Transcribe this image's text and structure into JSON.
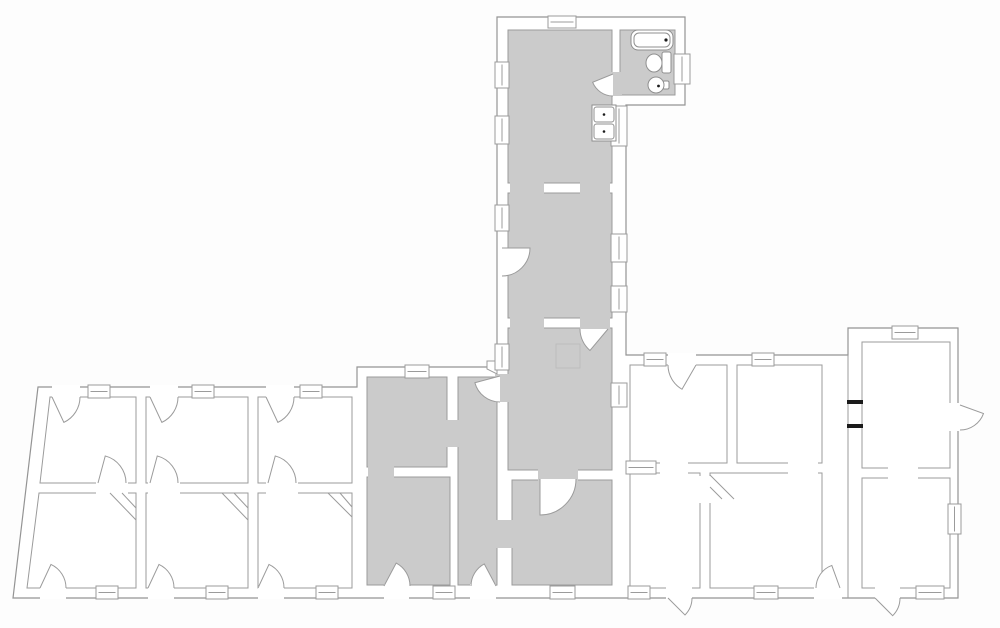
{
  "floor_plan": {
    "canvas": {
      "width": 1000,
      "height": 628,
      "background": "#fdfdfd"
    },
    "colors": {
      "wall_line": "#9b9b9b",
      "outline_line": "#949494",
      "room_fill": "#ffffff",
      "shaded_fill": "#cbcbcb",
      "fixture_line": "#8f8f8f",
      "black_accent": "#1b1b1b",
      "hatch_line": "#bdbdbd"
    },
    "outline": [
      [
        497,
        17
      ],
      [
        685,
        17
      ],
      [
        685,
        105
      ],
      [
        626,
        105
      ],
      [
        626,
        355
      ],
      [
        848,
        355
      ],
      [
        848,
        328
      ],
      [
        958,
        328
      ],
      [
        958,
        598
      ],
      [
        13,
        598
      ],
      [
        38,
        387
      ],
      [
        357,
        387
      ],
      [
        357,
        367
      ],
      [
        497,
        367
      ]
    ],
    "rooms": [
      {
        "id": "kitchen",
        "shaded": true,
        "rect": [
          508,
          30,
          104,
          153
        ]
      },
      {
        "id": "bathroom",
        "shaded": true,
        "rect": [
          620,
          30,
          55,
          65
        ]
      },
      {
        "id": "middle-room",
        "shaded": true,
        "rect": [
          508,
          193,
          104,
          125
        ]
      },
      {
        "id": "lower-room",
        "shaded": true,
        "rect": [
          508,
          328,
          104,
          142
        ]
      },
      {
        "id": "m1",
        "shaded": true,
        "rect": [
          367,
          377,
          80,
          90
        ]
      },
      {
        "id": "m2",
        "shaded": true,
        "rect": [
          367,
          477,
          83,
          108
        ]
      },
      {
        "id": "hallway",
        "shaded": true,
        "rect": [
          458,
          377,
          39,
          208
        ]
      },
      {
        "id": "m3",
        "shaded": true,
        "rect": [
          512,
          480,
          100,
          105
        ]
      },
      {
        "id": "a1",
        "shaded": false,
        "poly": [
          [
            50,
            397
          ],
          [
            136,
            397
          ],
          [
            136,
            483
          ],
          [
            40,
            483
          ]
        ]
      },
      {
        "id": "a2",
        "shaded": false,
        "rect": [
          146,
          397,
          102,
          86
        ]
      },
      {
        "id": "a3",
        "shaded": false,
        "rect": [
          258,
          397,
          94,
          86
        ]
      },
      {
        "id": "b1",
        "shaded": false,
        "poly": [
          [
            39,
            493
          ],
          [
            136,
            493
          ],
          [
            136,
            588
          ],
          [
            27,
            588
          ]
        ]
      },
      {
        "id": "b2",
        "shaded": false,
        "rect": [
          146,
          493,
          102,
          95
        ]
      },
      {
        "id": "b3",
        "shaded": false,
        "rect": [
          258,
          493,
          94,
          95
        ]
      },
      {
        "id": "r1",
        "shaded": false,
        "rect": [
          630,
          365,
          97,
          98
        ]
      },
      {
        "id": "r2",
        "shaded": false,
        "rect": [
          737,
          365,
          85,
          98
        ]
      },
      {
        "id": "r3",
        "shaded": false,
        "rect": [
          630,
          473,
          70,
          115
        ]
      },
      {
        "id": "r4",
        "shaded": false,
        "rect": [
          710,
          473,
          112,
          115
        ]
      },
      {
        "id": "f1",
        "shaded": false,
        "rect": [
          862,
          342,
          88,
          126
        ]
      },
      {
        "id": "f2",
        "shaded": false,
        "rect": [
          862,
          478,
          88,
          110
        ]
      }
    ],
    "wall_openings": [
      {
        "fill": "shaded",
        "rect": [
          510,
          181,
          34,
          14
        ]
      },
      {
        "fill": "shaded",
        "rect": [
          580,
          181,
          30,
          14
        ]
      },
      {
        "fill": "shaded",
        "rect": [
          510,
          316,
          34,
          14
        ]
      },
      {
        "fill": "shaded",
        "rect": [
          580,
          316,
          30,
          14
        ]
      },
      {
        "fill": "shaded",
        "rect": [
          610,
          72,
          12,
          24
        ]
      },
      {
        "fill": "shaded",
        "rect": [
          368,
          465,
          26,
          14
        ]
      },
      {
        "fill": "shaded",
        "rect": [
          445,
          420,
          15,
          27
        ]
      },
      {
        "fill": "shaded",
        "rect": [
          495,
          374,
          17,
          28
        ]
      },
      {
        "fill": "shaded",
        "rect": [
          495,
          520,
          19,
          28
        ]
      },
      {
        "fill": "shaded",
        "rect": [
          538,
          466,
          40,
          16
        ]
      },
      {
        "fill": "room",
        "rect": [
          96,
          481,
          32,
          14
        ]
      },
      {
        "fill": "room",
        "rect": [
          148,
          481,
          32,
          14
        ]
      },
      {
        "fill": "room",
        "rect": [
          266,
          481,
          32,
          14
        ]
      },
      {
        "fill": "room",
        "rect": [
          660,
          461,
          28,
          14
        ]
      },
      {
        "fill": "room",
        "rect": [
          788,
          461,
          30,
          14
        ]
      },
      {
        "fill": "room",
        "rect": [
          698,
          476,
          14,
          27
        ]
      },
      {
        "fill": "room",
        "rect": [
          888,
          466,
          30,
          14
        ]
      },
      {
        "fill": "room",
        "rect": [
          52,
          385,
          28,
          13
        ]
      },
      {
        "fill": "room",
        "rect": [
          150,
          385,
          28,
          13
        ]
      },
      {
        "fill": "room",
        "rect": [
          266,
          385,
          28,
          13
        ]
      },
      {
        "fill": "room",
        "rect": [
          40,
          586,
          26,
          13
        ]
      },
      {
        "fill": "room",
        "rect": [
          148,
          586,
          26,
          13
        ]
      },
      {
        "fill": "room",
        "rect": [
          258,
          586,
          26,
          13
        ]
      },
      {
        "fill": "room",
        "rect": [
          384,
          584,
          25,
          15
        ]
      },
      {
        "fill": "room",
        "rect": [
          470,
          584,
          26,
          15
        ]
      },
      {
        "fill": "room",
        "rect": [
          668,
          353,
          28,
          13
        ]
      },
      {
        "fill": "room",
        "rect": [
          666,
          586,
          26,
          13
        ]
      },
      {
        "fill": "room",
        "rect": [
          814,
          586,
          28,
          13
        ]
      },
      {
        "fill": "room",
        "rect": [
          875,
          586,
          25,
          13
        ]
      },
      {
        "fill": "room",
        "rect": [
          948,
          403,
          13,
          28
        ]
      }
    ],
    "extra_wall_lines": [
      [
        848,
        355,
        848,
        598
      ]
    ],
    "windows": [
      [
        548,
        16,
        28,
        12
      ],
      [
        495,
        62,
        14,
        26
      ],
      [
        495,
        116,
        14,
        28
      ],
      [
        611,
        106,
        16,
        40
      ],
      [
        674,
        54,
        16,
        30
      ],
      [
        495,
        205,
        14,
        26
      ],
      [
        611,
        234,
        16,
        28
      ],
      [
        611,
        286,
        16,
        26
      ],
      [
        495,
        344,
        14,
        26
      ],
      [
        611,
        383,
        16,
        24
      ],
      [
        88,
        385,
        22,
        13
      ],
      [
        192,
        385,
        22,
        13
      ],
      [
        300,
        385,
        22,
        13
      ],
      [
        96,
        586,
        22,
        13
      ],
      [
        206,
        586,
        22,
        13
      ],
      [
        316,
        586,
        22,
        13
      ],
      [
        405,
        365,
        24,
        13
      ],
      [
        433,
        586,
        22,
        13
      ],
      [
        550,
        586,
        25,
        13
      ],
      [
        644,
        353,
        22,
        13
      ],
      [
        752,
        353,
        22,
        13
      ],
      [
        626,
        461,
        30,
        13
      ],
      [
        628,
        586,
        22,
        13
      ],
      [
        754,
        586,
        24,
        13
      ],
      [
        892,
        326,
        26,
        13
      ],
      [
        948,
        504,
        13,
        30
      ],
      [
        916,
        586,
        28,
        13
      ]
    ],
    "doors": [
      {
        "id": "entry-a1",
        "hinge": [
          52,
          397
        ],
        "strike": [
          80,
          397
        ],
        "open_deg": 65
      },
      {
        "id": "entry-a2",
        "hinge": [
          150,
          397
        ],
        "strike": [
          178,
          397
        ],
        "open_deg": 65
      },
      {
        "id": "entry-a3",
        "hinge": [
          266,
          397
        ],
        "strike": [
          294,
          397
        ],
        "open_deg": 65
      },
      {
        "id": "mid-a1",
        "hinge": [
          98,
          483
        ],
        "strike": [
          126,
          483
        ],
        "open_deg": -75
      },
      {
        "id": "mid-a2",
        "hinge": [
          150,
          483
        ],
        "strike": [
          178,
          483
        ],
        "open_deg": -75
      },
      {
        "id": "mid-a3",
        "hinge": [
          268,
          483
        ],
        "strike": [
          296,
          483
        ],
        "open_deg": -75
      },
      {
        "id": "entry-b1",
        "hinge": [
          40,
          588
        ],
        "strike": [
          66,
          588
        ],
        "open_deg": -65
      },
      {
        "id": "entry-b2",
        "hinge": [
          148,
          588
        ],
        "strike": [
          174,
          588
        ],
        "open_deg": -65
      },
      {
        "id": "entry-b3",
        "hinge": [
          258,
          588
        ],
        "strike": [
          284,
          588
        ],
        "open_deg": -65
      },
      {
        "id": "entry-m2",
        "hinge": [
          384,
          586
        ],
        "strike": [
          410,
          586
        ],
        "open_deg": -62
      },
      {
        "id": "entry-hall",
        "hinge": [
          496,
          586
        ],
        "strike": [
          471,
          586
        ],
        "open_deg": 62
      },
      {
        "id": "kitchen-bath",
        "hinge": [
          613,
          74
        ],
        "strike": [
          613,
          96
        ],
        "open_deg": 68
      },
      {
        "id": "middle-room-west",
        "hinge": [
          502,
          248
        ],
        "strike": [
          502,
          276
        ],
        "open_deg": -90
      },
      {
        "id": "middle-lower",
        "hinge": [
          608,
          329
        ],
        "strike": [
          580,
          329
        ],
        "open_deg": -50
      },
      {
        "id": "hall-top",
        "hinge": [
          500,
          376
        ],
        "strike": [
          500,
          402
        ],
        "open_deg": 75
      },
      {
        "id": "lower-m3",
        "hinge": [
          540,
          479
        ],
        "strike": [
          576,
          479
        ],
        "open_deg": 90
      },
      {
        "id": "entry-r1",
        "hinge": [
          696,
          365
        ],
        "strike": [
          668,
          365
        ],
        "open_deg": -60
      },
      {
        "id": "entry-r3",
        "hinge": [
          668,
          598
        ],
        "strike": [
          692,
          598
        ],
        "open_deg": 45
      },
      {
        "id": "r4-rear",
        "hinge": [
          840,
          588
        ],
        "strike": [
          816,
          588
        ],
        "open_deg": 70
      },
      {
        "id": "entry-f2",
        "hinge": [
          875,
          598
        ],
        "strike": [
          900,
          598
        ],
        "open_deg": 45
      },
      {
        "id": "f1-side",
        "hinge": [
          960,
          405
        ],
        "strike": [
          960,
          430
        ],
        "open_deg": -70
      }
    ],
    "corner_diagonals": [
      [
        110,
        493,
        136,
        520
      ],
      [
        122,
        493,
        136,
        508
      ],
      [
        222,
        493,
        248,
        520
      ],
      [
        234,
        493,
        248,
        508
      ],
      [
        328,
        493,
        352,
        517
      ],
      [
        340,
        493,
        352,
        507
      ],
      [
        710,
        475,
        734,
        499
      ],
      [
        710,
        487,
        722,
        499
      ]
    ],
    "floor_hatch": [
      556,
      344,
      24,
      24
    ],
    "black_wall_caps": [
      [
        847,
        400,
        16,
        4
      ],
      [
        847,
        424,
        16,
        4
      ]
    ],
    "wall_notch": [
      [
        497,
        361
      ],
      [
        487,
        361
      ],
      [
        487,
        369
      ],
      [
        497,
        374
      ]
    ],
    "fixtures": {
      "bathtub": {
        "rect": [
          631,
          30,
          42,
          20
        ],
        "corner_radius": 7,
        "inset": 3,
        "drain": [
          666,
          40
        ]
      },
      "toilet": {
        "bowl_center": [
          654,
          63
        ],
        "bowl_rx": 8,
        "bowl_ry": 9,
        "tank_rect": [
          662,
          52,
          9,
          21
        ]
      },
      "round_sink": {
        "center": [
          656,
          85
        ],
        "radius": 8,
        "tap_rect": [
          663,
          81,
          6,
          8
        ]
      },
      "kitchen_sink": {
        "frame_rect": [
          592,
          105,
          24,
          36
        ],
        "basins": [
          [
            594,
            107,
            20,
            15
          ],
          [
            594,
            124,
            20,
            15
          ]
        ]
      }
    }
  }
}
